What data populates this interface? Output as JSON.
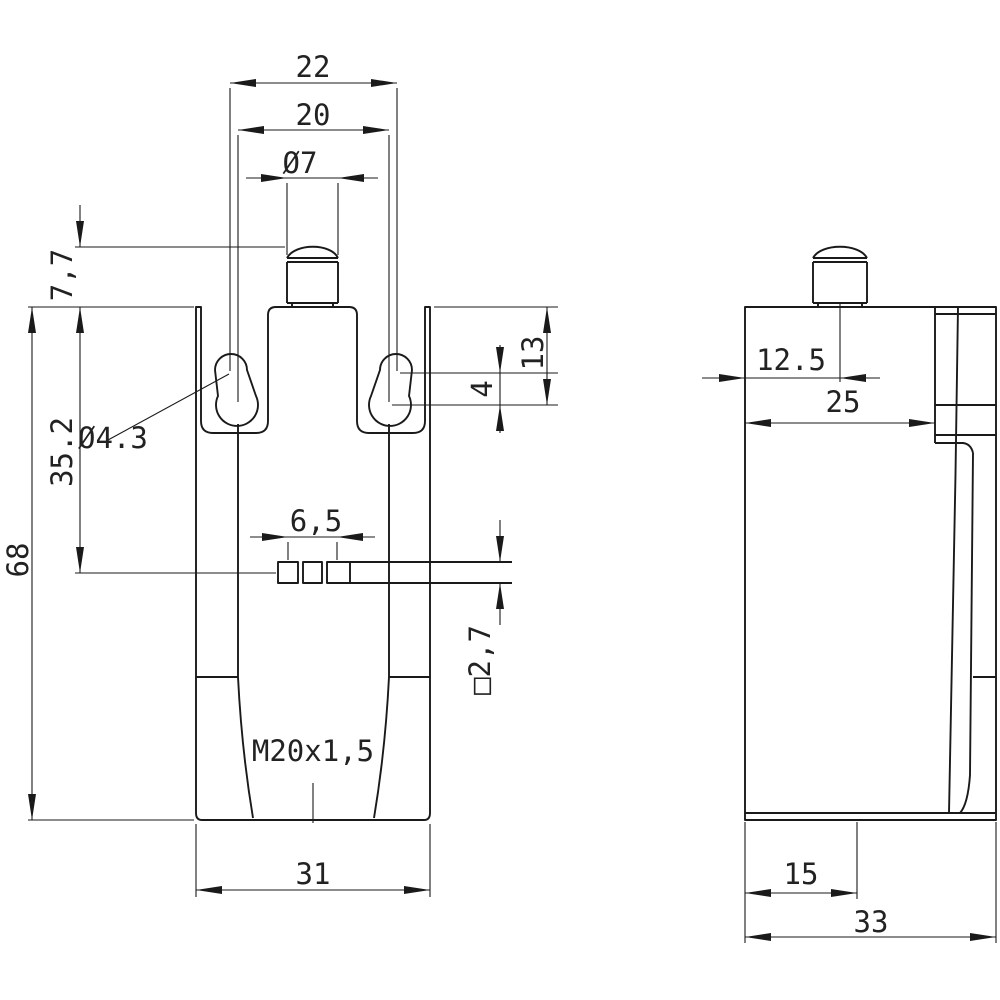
{
  "drawing": {
    "kind": "technical-dimension-drawing",
    "views": {
      "front": {
        "labels": {
          "dim22": "22",
          "dim20": "20",
          "dia7": "Ø7",
          "dim77": "7,7",
          "dim13": "13",
          "dim4": "4",
          "dia43": "Ø4.3",
          "dim352": "35.2",
          "dim68": "68",
          "dim65": "6,5",
          "sq27": "□2,7",
          "thread": "M20x1,5",
          "dim31": "31"
        }
      },
      "side": {
        "labels": {
          "dim125": "12.5",
          "dim25": "25",
          "dim15": "15",
          "dim33": "33"
        }
      }
    },
    "colors": {
      "line": "#1a1a1a",
      "background": "#ffffff"
    }
  }
}
